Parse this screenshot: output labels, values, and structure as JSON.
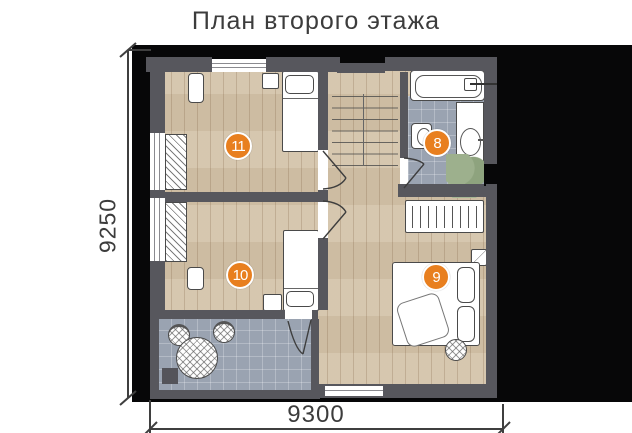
{
  "title": "План второго этажа",
  "dimensions": {
    "left_label": "9250",
    "bottom_label": "9300"
  },
  "rooms": [
    {
      "number": "11"
    },
    {
      "number": "8"
    },
    {
      "number": "10"
    },
    {
      "number": "9"
    }
  ],
  "colors": {
    "accent_orange": "#E87F1F",
    "wall_gray": "#57575D",
    "wood_floor": "#D4C4AA",
    "tile_gray": "#9AA3B1",
    "backdrop_black": "#070708",
    "text_gray": "#3C3C3C"
  }
}
